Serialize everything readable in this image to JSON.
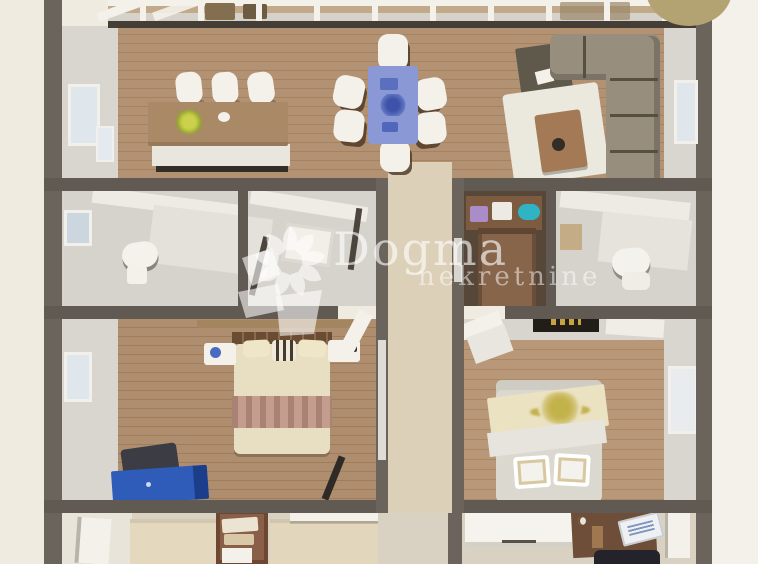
{
  "watermark": {
    "brand": "Dogma",
    "subtitle": "nekretnine",
    "logo": "pinwheel-flower-logo"
  },
  "scene": {
    "type": "3d-apartment-floor-plan-render",
    "view": "top-down",
    "rooms": [
      {
        "name": "open living / dining / kitchen",
        "furniture": [
          "kitchen island with flower decor",
          "3 white bar stools",
          "dining table with blue tablecloth",
          "6 white dining chairs",
          "grey L-shaped sectional sofa",
          "wooden coffee table",
          "white area rug",
          "dark media bench"
        ]
      },
      {
        "name": "bathroom left",
        "furniture": [
          "toilet",
          "window"
        ]
      },
      {
        "name": "shower room center-left",
        "furniture": [
          "shower tray"
        ]
      },
      {
        "name": "walk-in closet",
        "furniture": [
          "wardrobe shelving",
          "purple box",
          "teal box"
        ]
      },
      {
        "name": "bathroom right",
        "furniture": [
          "toilet",
          "tan cabinet"
        ]
      },
      {
        "name": "hallway",
        "furniture": [
          "white doors"
        ]
      },
      {
        "name": "bedroom left",
        "furniture": [
          "double bed cream bedding",
          "striped pillow",
          "2 nightstands",
          "wall shelf",
          "blue desk",
          "dark desk chair"
        ]
      },
      {
        "name": "bedroom right",
        "furniture": [
          "double bed with floral blanket",
          "2 framed pillows",
          "wall tv panel",
          "window"
        ]
      },
      {
        "name": "entry / office strip",
        "furniture": [
          "white entry door",
          "wooden shelf unit",
          "white cabinets",
          "wooden office desk",
          "laptop",
          "dark office chair"
        ]
      }
    ]
  },
  "palette": {
    "page_background": "#efebe1",
    "outer_wall": "#6b645c",
    "wood_floor_living": "#b19173",
    "wood_floor_bedrooms": "#ac8c6d",
    "hallway_floor": "#ddd0b8",
    "bathroom_floor": "#d6d3cc",
    "sofa_grey": "#978e7d",
    "dining_tablecloth_blue": "#8a99d6",
    "desk_blue": "#2f5cb8",
    "bed_cream": "#e8dfc2",
    "accent_circle_tan": "#b4a372",
    "watermark_white": "rgba(255,255,255,0.6)"
  }
}
